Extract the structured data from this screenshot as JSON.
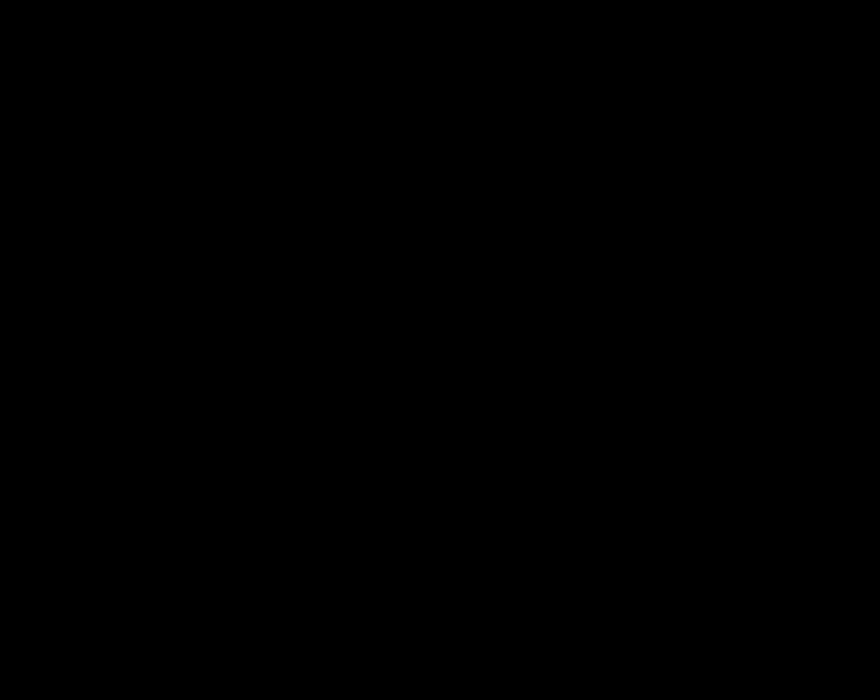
{
  "title_block": {
    "title": "屋面支撑布置图",
    "line2": "比例 1:150",
    "line3": "单位:mm"
  },
  "grid": {
    "top_labels": [
      "1",
      "2",
      "3",
      "4",
      "5",
      "6",
      "7",
      "8",
      "9",
      "10",
      "11",
      "12",
      "13"
    ],
    "bottom_labels": [
      "1",
      "2",
      "3",
      "4",
      "5",
      "6",
      "7",
      "8",
      "9",
      "10",
      "11",
      "12",
      "13",
      "14",
      "15"
    ],
    "side_labels": [
      "A",
      "B",
      "C",
      "D",
      "E",
      "F",
      "G",
      "H",
      "J",
      "K",
      "L",
      "M",
      "N",
      "P",
      "Q",
      "R"
    ],
    "bay_dim": "7500",
    "row_dim": "8000",
    "tick_text": "3150",
    "braced_bays": [
      4,
      11
    ]
  },
  "plan_labels": [
    {
      "x": 120,
      "y": 232,
      "top": "YC-1",
      "bot": "Φ114×3.0"
    },
    {
      "x": 157,
      "y": 232,
      "top": "YC-1",
      "bot": "Φ114×3.0"
    },
    {
      "x": 195,
      "y": 232,
      "top": "YC-1",
      "bot": "Φ114×3.0"
    },
    {
      "x": 370,
      "y": 232,
      "top": "YC-1",
      "bot": "Φ114×3.0"
    },
    {
      "x": 424,
      "y": 232,
      "top": "YC-2",
      "bot": "Φ114×3.5"
    },
    {
      "x": 301,
      "y": 471,
      "top": "XG-1",
      "bot": "Φ89×3.5"
    }
  ],
  "right_labels": {
    "text": "Φ108×4.00",
    "col1_x": 552,
    "col1_ys": [
      265,
      298,
      331,
      364,
      397,
      430,
      463,
      496,
      529,
      562,
      595,
      628
    ],
    "col2_x": 498,
    "col2_ys": [
      463,
      496,
      529,
      562,
      595,
      631
    ]
  },
  "fan_label": {
    "x": 64,
    "y": 640,
    "text": "风机"
  },
  "details": {
    "a_title": "XC1大样图",
    "a_note1": "M20",
    "a_note2": "-8",
    "b_title": "水平支撑连接大样",
    "b_note1": "Φ20",
    "b_note2": "150",
    "c_title": "节点详图一",
    "c_note1": "焊",
    "c_note2": "G",
    "d_title": "节点详图二",
    "d_note1": "焊",
    "d_note2": "Q",
    "e_title": "节点详图三"
  },
  "table": {
    "title": "材料表",
    "headers": [
      "编号",
      "规格",
      "材质",
      "数量",
      "备注"
    ],
    "rows": [
      [
        "XG1",
        "Φ108×4",
        "Q235B",
        "128",
        ""
      ],
      [
        "SC1",
        "Φ89×3.5",
        "Q235B",
        "64",
        ""
      ],
      [
        "YC1",
        "L50×4",
        "Q235B",
        "236",
        ""
      ]
    ]
  },
  "colors": {
    "frame": "#6f7c00",
    "green": "#00c800",
    "gray": "#969696",
    "brace": "#8f8f8f",
    "white": "#f2f2f2",
    "cyan": "#00ffff",
    "red": "#ff3232",
    "magenta": "#ff00ff",
    "yellow": "#e8e800",
    "blue": "#2a3cff",
    "dot": "#d8d800"
  }
}
